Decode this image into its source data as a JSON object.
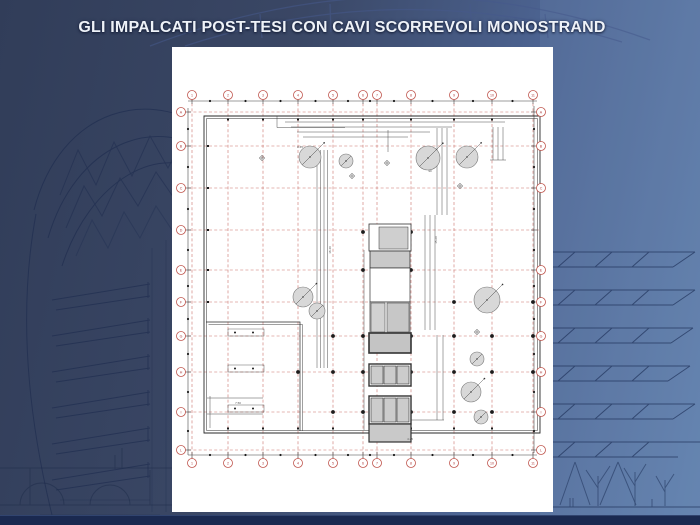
{
  "slide": {
    "title": "GLI IMPALCATI POST-TESI CON CAVI SCORREVOLI MONOSTRAND",
    "title_color": "#eef2f8",
    "background_colors": {
      "dark": "#313d59",
      "mid": "#4c6391",
      "light": "#6282af",
      "bottom_bar": "#1a2950"
    }
  },
  "plan": {
    "area": {
      "x": 172,
      "y": 47,
      "w": 381,
      "h": 465,
      "bg": "#ffffff"
    },
    "grid": {
      "color": "#c0574f",
      "cols": {
        "xs": [
          192,
          228,
          263,
          298,
          333,
          363,
          377,
          411,
          454,
          492,
          533
        ],
        "labels": [
          "1",
          "2",
          "3",
          "4",
          "5",
          "6",
          "7",
          "8",
          "9",
          "10",
          "11"
        ],
        "y_bubble_top": 95,
        "y_bubble_bottom": 463,
        "y1": 98,
        "y2": 460
      },
      "rows": {
        "ys": [
          112,
          146,
          188,
          230,
          270,
          302,
          336,
          372,
          412,
          450
        ],
        "labels": [
          "A",
          "B",
          "C",
          "D",
          "E",
          "F",
          "G",
          "H",
          "I",
          "L"
        ],
        "x_bubble_left": 181,
        "x1": 183,
        "x2": 539,
        "right": {
          "x_bubble": 541,
          "ys": [
            112,
            146,
            188,
            270,
            302,
            336,
            372,
            412,
            450
          ],
          "labels": [
            "A",
            "B",
            "C",
            "E",
            "F",
            "G",
            "H",
            "I",
            "L"
          ]
        }
      }
    },
    "bubbles": {
      "r": 4.5,
      "stroke": "#c0574f",
      "fill": "#ffffff",
      "label_color": "#b04040",
      "font_size": 3.6
    },
    "dims": {
      "color": "#3a3a3a",
      "perimeter": {
        "top_y": 101,
        "bottom_y": 455,
        "left_x": 188,
        "right_x": 534
      },
      "lines": [
        [
          317,
          150,
          317,
          368
        ],
        [
          320.5,
          150,
          320.5,
          368
        ],
        [
          324,
          150,
          324,
          368
        ],
        [
          327.5,
          150,
          327.5,
          368
        ],
        [
          285,
          122,
          505,
          122
        ],
        [
          291,
          127,
          452,
          127
        ],
        [
          297,
          132,
          430,
          132
        ],
        [
          303,
          137,
          408,
          137
        ],
        [
          493,
          127,
          493,
          160
        ],
        [
          498,
          127,
          498,
          160
        ],
        [
          503,
          127,
          503,
          160
        ],
        [
          490,
          160,
          506,
          160
        ],
        [
          425,
          215,
          425,
          330
        ],
        [
          430,
          215,
          430,
          330
        ],
        [
          435,
          215,
          435,
          330
        ],
        [
          437,
          128,
          437,
          215
        ],
        [
          442,
          128,
          442,
          215
        ],
        [
          447,
          128,
          447,
          215
        ],
        [
          437,
          335,
          437,
          420
        ],
        [
          443,
          335,
          443,
          420
        ],
        [
          374,
          420,
          444,
          420
        ],
        [
          207,
          398,
          263,
          398
        ],
        [
          207,
          414,
          263,
          414
        ],
        [
          210,
          396,
          210,
          428
        ],
        [
          277,
          116,
          277,
          127.5
        ],
        [
          277,
          127.5,
          345,
          127.5
        ],
        [
          364,
          250,
          364,
          430
        ],
        [
          388,
          130,
          388,
          152
        ]
      ]
    },
    "outline": {
      "color": "#2a2a2a",
      "paths": [
        {
          "d": "M204,116 H540 V433 H204 Z",
          "w": 0.9
        },
        {
          "d": "M206.5,118.5 H537.5 V430.5 H206.5 Z",
          "w": 0.5
        },
        {
          "d": "M206,322 H300 V431",
          "w": 0.7
        },
        {
          "d": "M208.5,324.5 H302.5 V431",
          "w": 0.45
        }
      ]
    },
    "core": {
      "stroke": "#333333",
      "rects": [
        {
          "x": 369,
          "y": 224,
          "w": 42,
          "h": 27,
          "fill": "#ffffff",
          "sw": 0.8
        },
        {
          "x": 370,
          "y": 251,
          "w": 40,
          "h": 17,
          "fill": "#c9c9c9",
          "sw": 0.8
        },
        {
          "x": 370,
          "y": 268,
          "w": 40,
          "h": 34,
          "fill": "#ffffff",
          "sw": 0.7
        },
        {
          "x": 370,
          "y": 302,
          "w": 40,
          "h": 31,
          "fill": "#ffffff",
          "sw": 0.7
        },
        {
          "x": 369,
          "y": 333,
          "w": 42,
          "h": 20,
          "fill": "#c4c4c4",
          "sw": 1.6
        },
        {
          "x": 369,
          "y": 364,
          "w": 42,
          "h": 22,
          "fill": "#ffffff",
          "sw": 1.4
        },
        {
          "x": 369,
          "y": 396,
          "w": 42,
          "h": 28,
          "fill": "#ffffff",
          "sw": 1.4
        },
        {
          "x": 369,
          "y": 424,
          "w": 42,
          "h": 18,
          "fill": "#c9c9c9",
          "sw": 1.2
        },
        {
          "x": 379,
          "y": 227,
          "w": 29,
          "h": 22,
          "fill": "#cfcfcf",
          "sw": 0.5
        },
        {
          "x": 371,
          "y": 303,
          "w": 14,
          "h": 29,
          "fill": "#d2d2d2",
          "sw": 0.5
        },
        {
          "x": 387,
          "y": 303,
          "w": 22,
          "h": 29,
          "fill": "#c7c7c7",
          "sw": 0.5
        },
        {
          "x": 371,
          "y": 366,
          "w": 12,
          "h": 18,
          "fill": "#cccccc",
          "sw": 0.6
        },
        {
          "x": 384,
          "y": 366,
          "w": 12,
          "h": 18,
          "fill": "#cccccc",
          "sw": 0.6
        },
        {
          "x": 397,
          "y": 366,
          "w": 12,
          "h": 18,
          "fill": "#cccccc",
          "sw": 0.6
        },
        {
          "x": 371,
          "y": 398,
          "w": 12,
          "h": 24,
          "fill": "#cccccc",
          "sw": 0.6
        },
        {
          "x": 384,
          "y": 398,
          "w": 12,
          "h": 24,
          "fill": "#cccccc",
          "sw": 0.6
        },
        {
          "x": 397,
          "y": 398,
          "w": 12,
          "h": 24,
          "fill": "#cccccc",
          "sw": 0.6
        }
      ]
    },
    "circles": {
      "fill": "#d8d8d8",
      "stroke": "#777777",
      "items": [
        [
          310,
          157,
          11
        ],
        [
          346,
          161,
          7
        ],
        [
          428,
          158,
          12
        ],
        [
          467,
          157,
          11
        ],
        [
          303,
          297,
          10
        ],
        [
          317,
          311,
          8
        ],
        [
          487,
          300,
          13
        ],
        [
          477,
          359,
          7
        ],
        [
          471,
          392,
          10
        ],
        [
          481,
          417,
          7
        ]
      ]
    },
    "crosses": [
      [
        262,
        158
      ],
      [
        387,
        163
      ],
      [
        352,
        176
      ],
      [
        460,
        186
      ],
      [
        477,
        332
      ]
    ],
    "dots": {
      "color": "#1c1c1c",
      "r_small": 1.1,
      "r_medium": 1.9,
      "medium": [
        [
          454,
          302
        ],
        [
          492,
          302
        ],
        [
          533,
          302
        ],
        [
          333,
          336
        ],
        [
          363,
          336
        ],
        [
          411,
          336
        ],
        [
          454,
          336
        ],
        [
          492,
          336
        ],
        [
          533,
          336
        ],
        [
          298,
          372
        ],
        [
          333,
          372
        ],
        [
          363,
          372
        ],
        [
          411,
          372
        ],
        [
          454,
          372
        ],
        [
          492,
          372
        ],
        [
          533,
          372
        ],
        [
          333,
          412
        ],
        [
          363,
          412
        ],
        [
          411,
          412
        ],
        [
          454,
          412
        ],
        [
          492,
          412
        ],
        [
          363,
          232
        ],
        [
          363,
          270
        ],
        [
          411,
          232
        ],
        [
          411,
          270
        ]
      ],
      "edge_squares_top_y": 119.5,
      "edge_squares_top_xs": [
        228,
        263,
        298,
        333,
        363,
        411,
        454,
        492
      ],
      "edge_squares_bottom_y": 428.5,
      "edge_squares_bottom_xs": [
        228,
        263,
        298,
        333,
        411,
        454,
        492
      ],
      "edge_squares_left_x": 208,
      "edge_squares_left_ys": [
        146,
        188,
        230,
        270,
        302
      ]
    },
    "tables": [
      {
        "x": 228,
        "y": 329,
        "w": 36,
        "h": 7
      },
      {
        "x": 228,
        "y": 365,
        "w": 36,
        "h": 7
      },
      {
        "x": 228,
        "y": 405,
        "w": 36,
        "h": 7
      }
    ],
    "tiny_labels": {
      "color": "#555555",
      "font_size": 3,
      "items": [
        {
          "t": "15.20",
          "x": 437,
          "y": 240,
          "rot": -90
        },
        {
          "t": "18.40",
          "x": 331,
          "y": 250,
          "rot": -90
        },
        {
          "t": "8.45",
          "x": 300,
          "y": 148,
          "rot": 0
        },
        {
          "t": "7.50",
          "x": 238,
          "y": 404,
          "rot": 0
        },
        {
          "t": "4.25",
          "x": 410,
          "y": 440,
          "rot": 0
        },
        {
          "t": "90",
          "x": 430,
          "y": 172,
          "rot": 0
        }
      ]
    }
  }
}
